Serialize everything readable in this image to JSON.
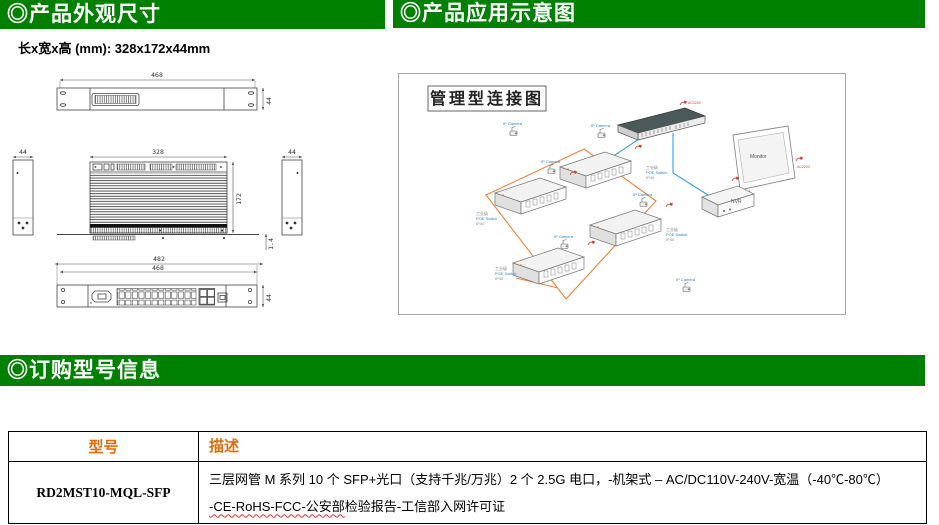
{
  "colors": {
    "header_green": "#008000",
    "table_header_text": "#e26b0a",
    "diagram_ring": "#e8823c",
    "diagram_cable": "#3b9ddd",
    "label_blue": "#2b7fd4",
    "power_red": "#cc4433"
  },
  "section_headers": {
    "appearance": "◎产品外观尺寸",
    "application": "◎产品应用示意图",
    "ordering": "◎订购型号信息"
  },
  "spec_note": "长x宽x高 (mm): 328x172x44mm",
  "drawings": {
    "back_view": {
      "width_dim": "468",
      "height_dim": "44"
    },
    "side_left": {
      "width_dim": "44"
    },
    "side_right": {
      "width_dim": "44"
    },
    "top_view": {
      "width_dim": "328",
      "depth_dim": "172",
      "thickness_dim": "1.4"
    },
    "front_view": {
      "outer_width_dim": "482",
      "inner_width_dim": "468",
      "height_dim": "44"
    }
  },
  "application_diagram": {
    "title": "管理型连接图",
    "labels": {
      "nvr": "NVR",
      "monitor": "Monitor",
      "camera": "IP Camera",
      "device_line1": "工业级",
      "device_line2": "POE Switch",
      "device_line3": "IP40",
      "power": "AC220V"
    }
  },
  "order_section": {
    "table": {
      "col_model": "型号",
      "col_desc": "描述",
      "row": {
        "model": "RD2MST10-MQL-SFP",
        "desc_line1": "三层网管 M 系列 10 个 SFP+光口（支持千兆/万兆）2 个 2.5G 电口，-机架式 – AC/DC110V-240V-宽温（-40℃-80℃）",
        "desc_line2_wavy": "-CE-RoHS-FCC-公安部",
        "desc_line2_rest": "检验报告-工信部入网许可证"
      }
    }
  }
}
